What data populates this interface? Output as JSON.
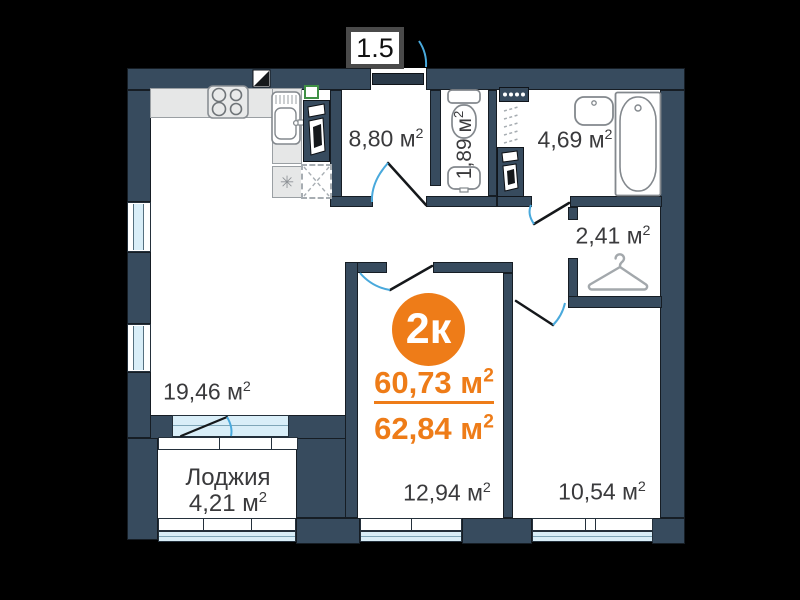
{
  "scale_badge": "1.5",
  "sup": "2",
  "summary": {
    "rooms_short": "2к",
    "living_area": "60,73 м",
    "total_area": "62,84 м"
  },
  "rooms": {
    "kitchen_living": "19,46 м",
    "hallway": "8,80 м",
    "wc": "1,89 м",
    "bathroom": "4,69 м",
    "entry_hall": "2,41 м",
    "bedroom_1": "12,94 м",
    "bedroom_2": "10,54 м",
    "loggia_name": "Лоджия",
    "loggia_area": "4,21 м"
  },
  "icons": {
    "fridge_asterisk": "✳"
  },
  "colors": {
    "wall": "#374B5E",
    "accent_orange": "#EE7C18",
    "door_arc": "#49A9DC",
    "glass": "#D9EEF8",
    "background": "#000000"
  }
}
